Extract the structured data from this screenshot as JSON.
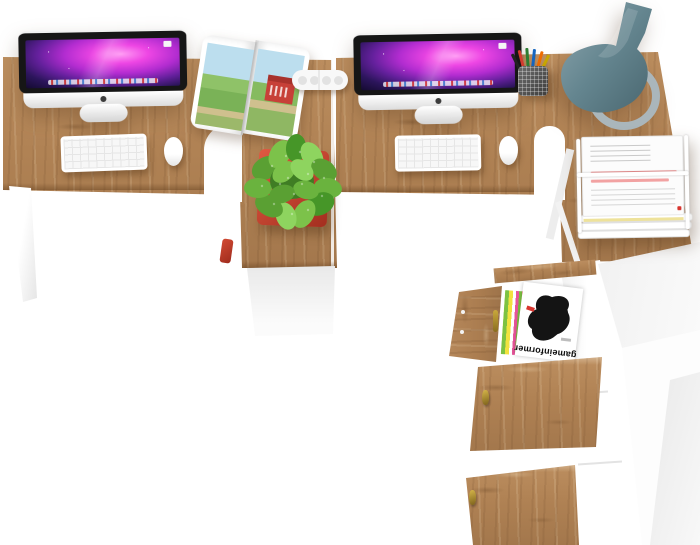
{
  "scene": {
    "description": "3D product render, top view of a two-person office workstation set: two oak-and-white L-shaped desks with iMacs, keyboards and mice, an open magazine, a potted plant on the left return, a pencil cup, a teal vase, a wire letter tray with documents, and a tall white shelf cabinet with oak doors holding magazines",
    "background": "#ffffff"
  },
  "palette": {
    "wood": "#b0824f",
    "wood_dark": "#8a6340",
    "white_furniture": "#ffffff",
    "pot_red": "#c8402e",
    "plant_green": "#68b43d",
    "vase_teal": "#6b8b95",
    "screen_magenta": "#ee46e4",
    "handle_gold": "#a8862d",
    "document_accent_red": "#ea7070",
    "barn_red": "#c74038"
  },
  "objects": {
    "desk_left": "left desk with return pedestal",
    "desk_right": "right desk with return",
    "imac_left": "iMac all-in-one computer",
    "imac_right": "iMac all-in-one computer",
    "keyboard_left": "white wireless keyboard",
    "keyboard_right": "white wireless keyboard",
    "mouse_left": "white mouse",
    "mouse_right": "white mouse",
    "open_magazine": "open magazine with red barn landscape photo",
    "cable_block": "white cable connector block",
    "plant": "green potted plant in red planter",
    "pencil_cup": "mesh pencil cup with colored pens",
    "vase": "teal decorative vase",
    "paper_tray": "white wire letter tray with paper documents",
    "shelf_unit": "tall white shelf cabinet with oak doors and magazine rack"
  },
  "shelf": {
    "magazine_title": "gameinformer"
  }
}
